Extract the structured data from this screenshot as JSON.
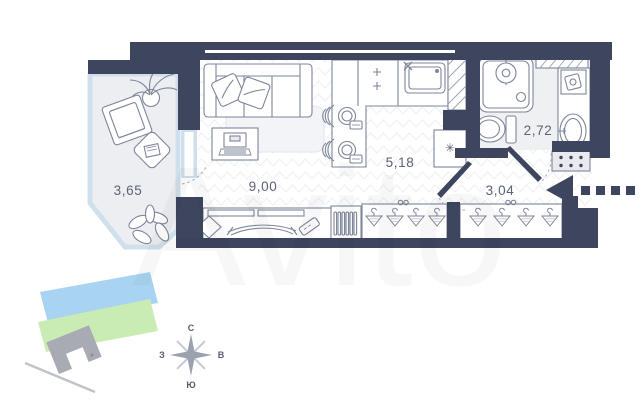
{
  "floor_plan": {
    "room_areas": {
      "balcony": "3,65",
      "living_room": "9,00",
      "kitchen": "5,18",
      "bathroom": "2,72",
      "hallway": "3,04"
    },
    "fridge_symbol": "✳"
  },
  "compass": {
    "north": "С",
    "east": "В",
    "south": "Ю",
    "west": "З"
  },
  "watermark_text": "Avito",
  "colors": {
    "wall": "#3e455f",
    "floor_pattern": "#eff1f5",
    "balcony_floor": "#eceef1",
    "bathroom_floor": "#eef0f2",
    "glazing": "#cfe0ec",
    "furniture_line": "#7d859a",
    "label_text": "#5c6374",
    "river": "#a9d4f1",
    "lawn": "#c9ecb4",
    "building": "#a9abb4",
    "compass_rose": "#9aa2ae"
  }
}
